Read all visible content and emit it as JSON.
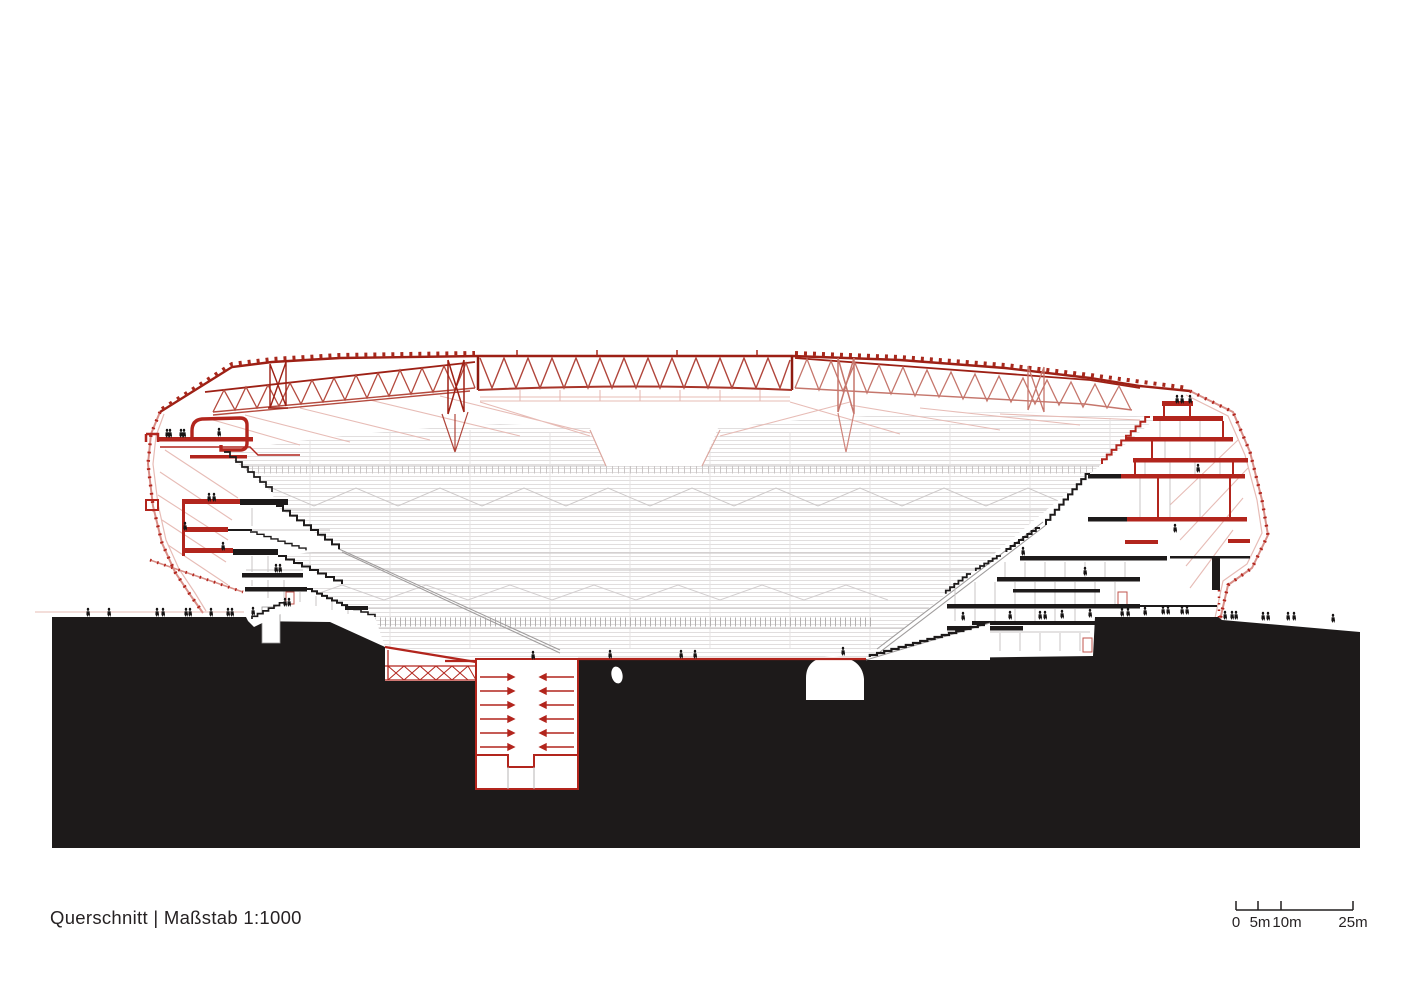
{
  "sheet": {
    "background": "#ffffff",
    "kind": "architectural section drawing, stadium"
  },
  "title_block": {
    "full": "Querschnitt | Maßstab 1:1000",
    "view_name": "Querschnitt",
    "separator": "|",
    "scale_text": "Maßstab 1:1000"
  },
  "scale_bar": {
    "unit": "m",
    "total_m": 25,
    "labels": [
      "0",
      "5m",
      "10m",
      "25m"
    ],
    "tick_positions_m": [
      0,
      5,
      10,
      25
    ]
  },
  "colors": {
    "cut_red": "#b2251d",
    "truss_dark_red": "#9d2015",
    "truss_red": "#b0453b",
    "truss_light_red": "#c5766c",
    "pink_line": "#e7bcb6",
    "facade_pink": "#d98f88",
    "ink_black": "#1d1a1a",
    "gray_line": "#e1dede",
    "gray_mid": "#c6c2c2",
    "text": "#262223"
  }
}
